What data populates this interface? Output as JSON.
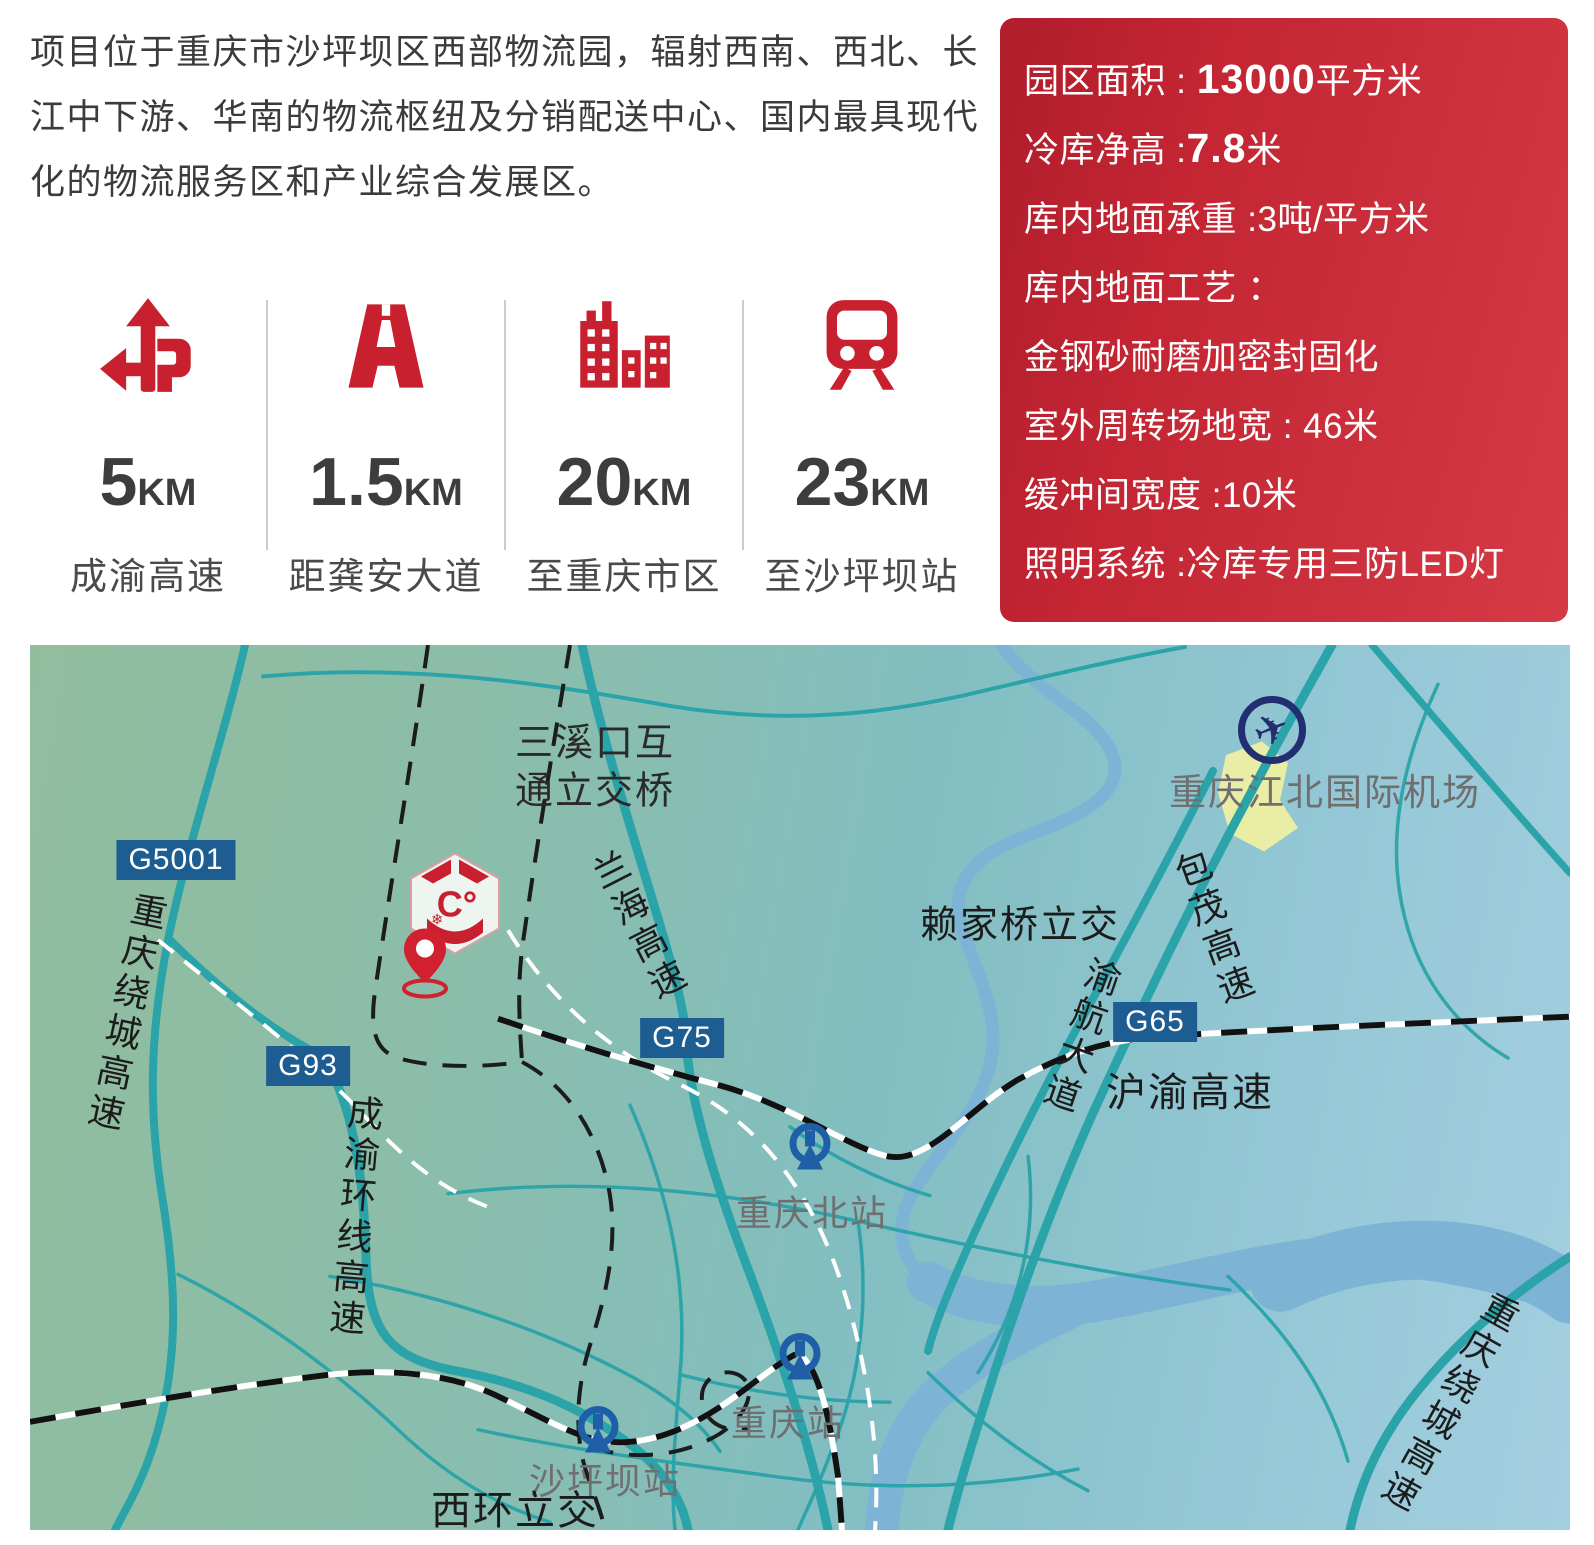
{
  "intro": {
    "text": "项目位于重庆市沙坪坝区西部物流园，辐射西南、西北、长江中下游、华南的物流枢纽及分销配送中心、国内最具现代化的物流服务区和产业综合发展区。"
  },
  "stats": [
    {
      "icon": "junction-icon",
      "value": "5",
      "unit": "KM",
      "label": "成渝高速"
    },
    {
      "icon": "highway-icon",
      "value": "1.5",
      "unit": "KM",
      "label": "距龚安大道"
    },
    {
      "icon": "city-icon",
      "value": "20",
      "unit": "KM",
      "label": "至重庆市区"
    },
    {
      "icon": "train-icon",
      "value": "23",
      "unit": "KM",
      "label": "至沙坪坝站"
    }
  ],
  "specs": {
    "lines": [
      {
        "pre": "园区面积 : ",
        "strong": "13000",
        "post": "平方米"
      },
      {
        "pre": "冷库净高 :",
        "strong": "7.8",
        "post": "米"
      },
      {
        "pre": "库内地面承重 :3吨/平方米",
        "strong": "",
        "post": ""
      },
      {
        "pre": "库内地面工艺 ：",
        "strong": "",
        "post": ""
      },
      {
        "pre": "金钢砂耐磨加密封固化",
        "strong": "",
        "post": ""
      },
      {
        "pre": "室外周转场地宽 : 46米",
        "strong": "",
        "post": ""
      },
      {
        "pre": "缓冲间宽度 :10米",
        "strong": "",
        "post": ""
      },
      {
        "pre": "照明系统 :冷库专用三防LED灯",
        "strong": "",
        "post": ""
      }
    ]
  },
  "map": {
    "badges": {
      "g5001": "G5001",
      "g93": "G93",
      "g75": "G75",
      "g65": "G65"
    },
    "labels": {
      "sanxikou1": "三溪口互",
      "sanxikou2": "通立交桥",
      "raocheng_w": "重庆绕城高速",
      "chengyu_ring": "成渝环线高速",
      "lanhai": "兰海高速",
      "airport": "重庆江北国际机场",
      "baomao": "包茂高速",
      "laijiaqiao": "赖家桥立交",
      "yuhang": "渝航大道",
      "huyu": "沪渝高速",
      "cq_north": "重庆北站",
      "cq_station": "重庆站",
      "shapingba": "沙坪坝站",
      "xihuan": "西环立交",
      "raocheng_se": "重庆绕城高速"
    },
    "logo": {
      "text": "C°",
      "snowflake": "❄"
    },
    "plane_glyph": "✈"
  },
  "colors": {
    "accent_red": "#c9202f",
    "badge_blue": "#1d5d92",
    "road_teal": "#2aa3a9",
    "river_blue": "#7db4d6",
    "rail_blue": "#1f5fa8",
    "plane_navy": "#232d72"
  }
}
